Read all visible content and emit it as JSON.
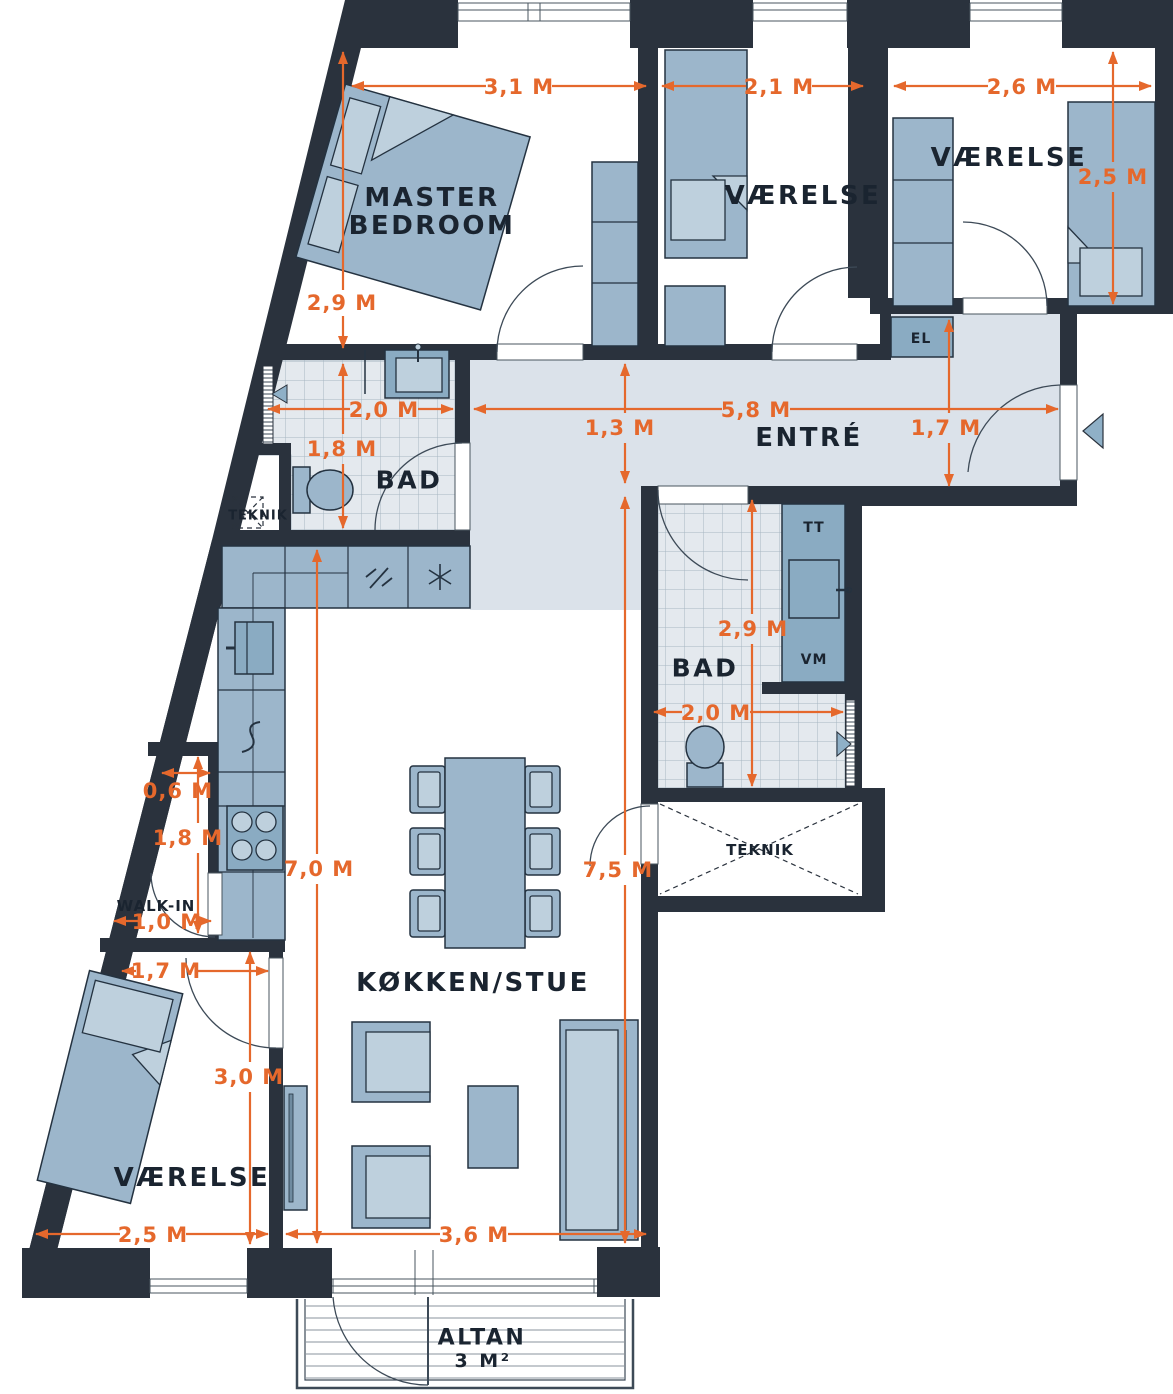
{
  "rooms": {
    "master_line1": "MASTER",
    "master_line2": "BEDROOM",
    "bedroom_top": "VÆRELSE",
    "bedroom_right": "VÆRELSE",
    "bedroom_bottom": "VÆRELSE",
    "bath_left": "BAD",
    "bath_right": "BAD",
    "entry": "ENTRÉ",
    "kitchen_living": "KØKKEN/STUE",
    "walk_in": "WALK-IN",
    "teknik_left": "TEKNIK",
    "teknik_right": "TEKNIK",
    "el": "EL",
    "tt": "TT",
    "vm": "VM",
    "balcony": "ALTAN",
    "balcony_area": "3 M²"
  },
  "dims": {
    "master_width": "3,1 M",
    "master_depth": "2,9 M",
    "bedroom_top_width": "2,1 M",
    "bedroom_right_width": "2,6 M",
    "bedroom_right_depth": "2,5 M",
    "bath_left_width": "2,0 M",
    "bath_left_depth": "1,8 M",
    "hall_width": "5,8 M",
    "hall_depth": "1,3 M",
    "entry_depth": "1,7 M",
    "bath_right_depth": "2,9 M",
    "bath_right_width": "2,0 M",
    "walkin_top_width": "0,6 M",
    "walkin_depth": "1,8 M",
    "walkin_width": "1,0 M",
    "kitchen_depth": "7,0 M",
    "living_depth": "7,5 M",
    "bedroom_bottom_door": "1,7 M",
    "bedroom_bottom_depth": "3,0 M",
    "bedroom_bottom_width": "2,5 M",
    "living_width": "3,6 M"
  },
  "colors": {
    "wall": "#2a323d",
    "dimension_accent": "#e5682c",
    "furniture": "#9cb6cb",
    "furniture_light": "#bed0dd",
    "appliance": "#8aabc2",
    "entry_floor": "#dbe2ea",
    "tile_floor": "#e4e9ee",
    "tile_grid": "#a7b6c2",
    "label_text": "#1a2430"
  }
}
